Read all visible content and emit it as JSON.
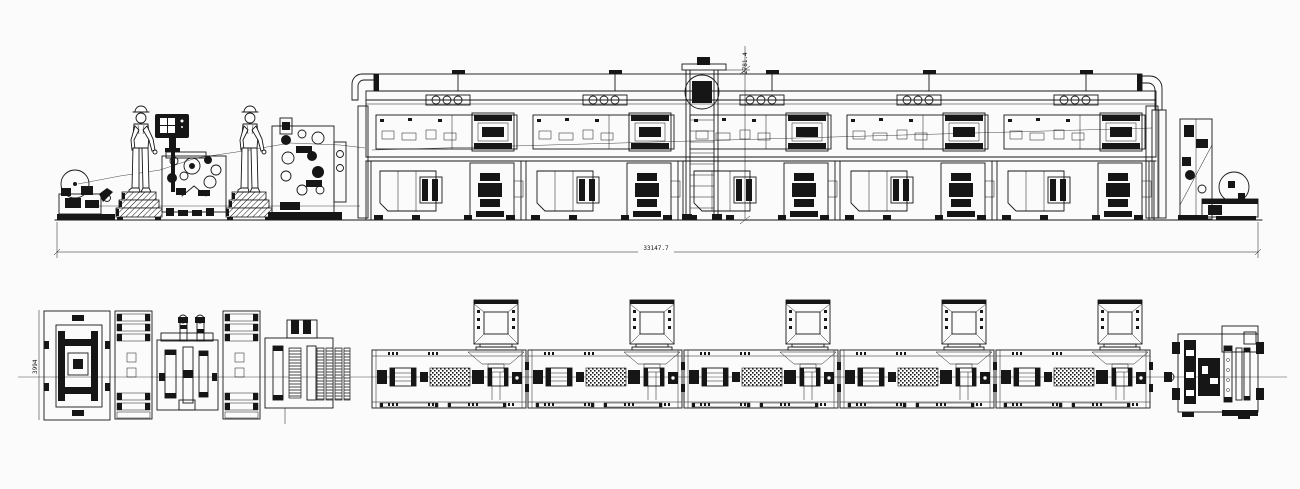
{
  "canvas": {
    "width": 1300,
    "height": 489,
    "background_color": "#fbfbfb",
    "line_color": "#161616"
  },
  "annotations": {
    "overall_length": "33147.7",
    "overall_height": "2781.4",
    "line_width": "3994"
  },
  "equipment": {
    "oven_module_count": 5,
    "exhaust_hood_count": 5,
    "operator_count": 2
  }
}
